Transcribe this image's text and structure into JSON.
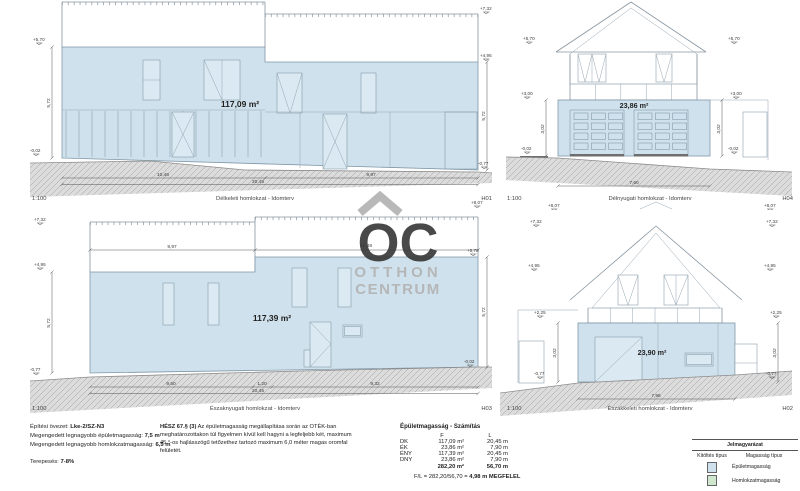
{
  "panels": {
    "p1": {
      "scale": "1:100",
      "title": "Délkeleti homlokzat - Idomterv",
      "code": "H01",
      "area": "117,09 m²",
      "marks": {
        "eave_left": "+5,70",
        "base_left": "-0,02",
        "top_right": "+7,32",
        "eave_right": "+4,95",
        "base_right": "-0,77",
        "ridge_next": "+8,07"
      },
      "heights": {
        "left": "5,72",
        "right": "5,72"
      },
      "dims": {
        "left": "10,46",
        "right": "9,97",
        "total": "20,45"
      }
    },
    "p2": {
      "scale": "1:100",
      "title": "Délnyugati homlokzat - Idomterv",
      "code": "H04",
      "area": "23,86 m²",
      "marks": {
        "eave_left": "+5,70",
        "eave_right": "+5,70",
        "mid_left": "+3,00",
        "mid_right": "+3,00",
        "base_left": "-0,02",
        "base_right": "-0,02",
        "ridge_below_left": "+8,07",
        "ridge_below_right": "+8,07"
      },
      "heights": {
        "left": "3,02",
        "right": "3,02"
      },
      "dims": {
        "total": "7,60"
      }
    },
    "p3": {
      "scale": "1:100",
      "title": "Északnyugati homlokzat - Idomterv",
      "code": "H03",
      "area": "117,39 m²",
      "marks": {
        "top_left": "+7,32",
        "eave_left": "+4,95",
        "base_left": "-0,77",
        "eave_right": "+5,70",
        "base_right": "-0,02"
      },
      "heights": {
        "left": "5,72",
        "right": "5,72"
      },
      "dims": {
        "top_left": "9,97",
        "top_right": "10,48",
        "bottom_a": "9,50",
        "bottom_b": "1,20",
        "bottom_c": "9,32",
        "total": "20,45"
      }
    },
    "p4": {
      "scale": "1:100",
      "title": "Északkeleti homlokzat - Idomterv",
      "code": "H02",
      "area": "23,90 m²",
      "marks": {
        "top_left": "+7,32",
        "top_right": "+7,32",
        "upper_left": "+4,95",
        "upper_right": "+4,95",
        "mid_left": "+2,25",
        "mid_right": "+2,25",
        "base_left": "-0,77",
        "base_right": "-0,77"
      },
      "heights": {
        "left": "3,02",
        "right": "3,02"
      },
      "dims": {
        "total": "7,96"
      }
    }
  },
  "notes": {
    "zone_label": "Építési övezet:",
    "zone_value": "Lke-2/SZ-N3",
    "line2_label": "Megengedett legnagyobb épületmagasság:",
    "line2_value": "7,5 m",
    "line3_label": "Megengedett legnagyobb homlokzatmagasság:",
    "line3_value": "6,5 m",
    "line4_label": "Terepesés:",
    "line4_value": "7-8%"
  },
  "hesz": {
    "ref": "HÉSZ 67.§ (3)",
    "body": "Az épületmagasság megállapítása során az OTÉK-ban meghatározottakon túl figyelmen kívül kell hagyni a legfeljebb két, maximum 45 °-os hajlásszögű tetőzethez tartozó maximum 6,0 méter magas oromfal felületét."
  },
  "calc": {
    "title": "Épületmagasság - Számítás",
    "col_f": "F",
    "col_l": "L",
    "rows": [
      {
        "label": "DK",
        "f": "117,09 m²",
        "l": "20,45 m"
      },
      {
        "label": "ÉK",
        "f": "23,86 m²",
        "l": "7,90 m"
      },
      {
        "label": "ÉNY",
        "f": "117,39 m²",
        "l": "20,45 m"
      },
      {
        "label": "DNY",
        "f": "23,86 m²",
        "l": "7,90 m"
      }
    ],
    "total_f": "282,20 m²",
    "total_l": "56,70 m",
    "result_prefix": "F/L = 282,20/56,70 = ",
    "result_value": "4,98 m MEGFELEL"
  },
  "legend": {
    "title": "Jelmagyarázat",
    "col_fill": "Kitöltés típus",
    "col_height": "Magasság típus",
    "rows": [
      {
        "label": "Épületmagasság"
      },
      {
        "label": "Homlokzatmagasság"
      }
    ]
  },
  "watermark": {
    "logo": "OC",
    "line1": "OTTHON",
    "line2": "CENTRUM"
  },
  "colors": {
    "building_fill": "#cfe1ec",
    "homlokzat_fill": "#cfe6cf",
    "ground": "#dcdcdc",
    "line": "#8795a1",
    "dim": "#555555",
    "watermark": "#b3b3b3"
  }
}
